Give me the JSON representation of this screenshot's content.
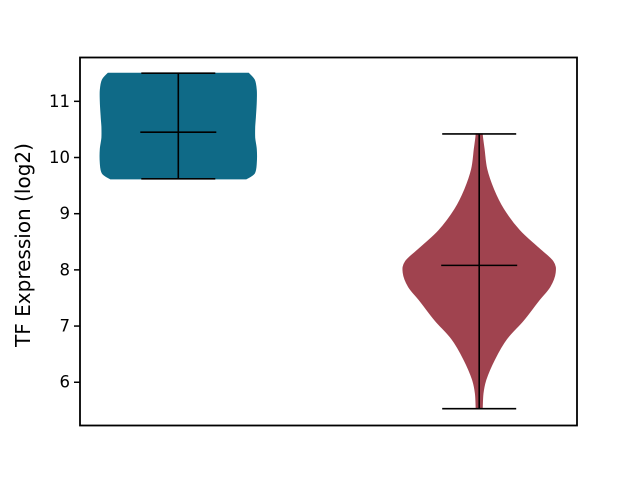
{
  "figure": {
    "width": 640,
    "height": 480,
    "background": "#ffffff"
  },
  "chart_data": {
    "type": "violin",
    "ylabel": "TF Expression (log2)",
    "yticks": [
      6,
      7,
      8,
      9,
      10,
      11
    ],
    "ylim": [
      5.23,
      11.78
    ],
    "grid": false,
    "legend": "none",
    "x_tick_labels_visible": false,
    "spine_color": "#000000",
    "stat_line_color": "#000000",
    "axes_px": {
      "left": 80,
      "top": 57.5,
      "right": 577,
      "bottom": 425.5
    },
    "series": [
      {
        "name": "violin-1",
        "color": "#0f6a87",
        "center_px": 178.3,
        "half_width_px": 78,
        "cap_half_px": 37,
        "mean_half_px": 38,
        "min": 9.62,
        "max": 11.5,
        "mean": 10.45,
        "profile": [
          [
            9.62,
            0.87
          ],
          [
            9.72,
            0.975
          ],
          [
            9.9,
            1.0
          ],
          [
            10.15,
            1.0
          ],
          [
            10.35,
            0.98
          ],
          [
            10.55,
            0.98
          ],
          [
            10.75,
            0.99
          ],
          [
            11.0,
            1.0
          ],
          [
            11.2,
            1.0
          ],
          [
            11.38,
            0.975
          ],
          [
            11.5,
            0.9
          ]
        ]
      },
      {
        "name": "violin-2",
        "color": "#a0434f",
        "center_px": 479.2,
        "half_width_px": 76,
        "cap_half_px": 37,
        "mean_half_px": 38,
        "min": 5.53,
        "max": 10.42,
        "mean": 8.08,
        "profile": [
          [
            5.53,
            0.04
          ],
          [
            5.8,
            0.05
          ],
          [
            6.05,
            0.09
          ],
          [
            6.4,
            0.2
          ],
          [
            6.77,
            0.36
          ],
          [
            7.1,
            0.58
          ],
          [
            7.45,
            0.78
          ],
          [
            7.7,
            0.93
          ],
          [
            7.95,
            1.0
          ],
          [
            8.15,
            0.97
          ],
          [
            8.4,
            0.77
          ],
          [
            8.7,
            0.53
          ],
          [
            9.08,
            0.32
          ],
          [
            9.43,
            0.19
          ],
          [
            9.79,
            0.1
          ],
          [
            10.15,
            0.065
          ],
          [
            10.35,
            0.045
          ],
          [
            10.42,
            0.04
          ]
        ]
      }
    ]
  }
}
